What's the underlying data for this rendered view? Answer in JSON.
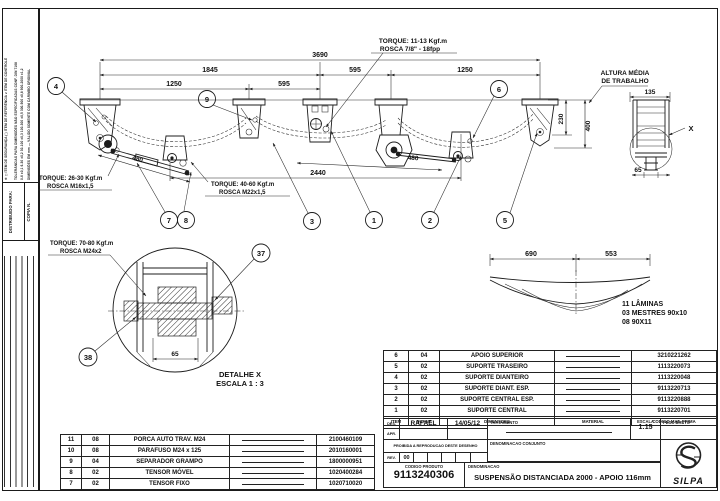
{
  "margin": {
    "note_symbols": "⊕   ◻ ITEM DE SEGURANÇA   ( ) ITEM DE REFERÊNCIA   ⌀ ITEM DE CONTROLE",
    "note_tol1": "TOLERÂNCIAS PARA DIMENSÕES NÃO ESPECIFICADAS CONF. DIN 7168",
    "note_tol2": "0-6 ±0,1   6-30 ±0,2   30-100 ±0,3   100-300 ±0,5   300-900 ±0,8   900-2000 ±1,2",
    "note_tol3": "DIMENSÕES EM mm — VÁLIDO SOMENTE COM CARIMBO ORIGINAL",
    "distribuido": "DISTRIBUIDO PARA:",
    "copia": "COPIA N."
  },
  "drawing": {
    "dims": {
      "total": "3690",
      "span_front": "1845",
      "span_mid": "595",
      "span_rear": "1250",
      "sub_front": "1250",
      "sub_mid": "595",
      "axles": "2440",
      "tensor_front": "480",
      "tensor_rear": "480",
      "h230": "230",
      "h400": "400",
      "w135": "135",
      "w65_side": "65"
    },
    "notes": {
      "torque_top1": "TORQUE: 11-13 Kgf.m",
      "torque_top2": "ROSCA 7/8\" - 18fpp",
      "torque_left1": "TORQUE: 26-30 Kgf.m",
      "torque_left2": "ROSCA M16x1,5",
      "torque_mid1": "TORQUE: 40-60 Kgf.m",
      "torque_mid2": "ROSCA M22x1,5",
      "altura1": "ALTURA MÉDIA",
      "altura2": "DE TRABALHO",
      "x_label": "X"
    },
    "balloons": {
      "b1": "1",
      "b2": "2",
      "b3": "3",
      "b4": "4",
      "b5": "5",
      "b6": "6",
      "b7": "7",
      "b8": "8",
      "b9": "9",
      "b37": "37",
      "b38": "38"
    },
    "spring": {
      "d_left": "690",
      "d_right": "553",
      "line1": "11 LÂMINAS",
      "line2": "03 MESTRES 90x10",
      "line3": "08 90X11"
    },
    "detail": {
      "torque1": "TORQUE: 70-80 Kgf.m",
      "torque2": "ROSCA M24x2",
      "dim": "65",
      "title": "DETALHE X",
      "scale": "ESCALA 1 : 3"
    }
  },
  "tables": {
    "left": {
      "rows": [
        {
          "item": "11",
          "qty": "08",
          "desc": "PORCA AUTO TRAV. M24",
          "code": "2100460109"
        },
        {
          "item": "10",
          "qty": "08",
          "desc": "PARAFUSO M24 x 125",
          "code": "2010160001"
        },
        {
          "item": "9",
          "qty": "04",
          "desc": "SEPARADOR GRAMPO",
          "code": "1800000951"
        },
        {
          "item": "8",
          "qty": "02",
          "desc": "TENSOR MÓVEL",
          "code": "1020400284"
        },
        {
          "item": "7",
          "qty": "02",
          "desc": "TENSOR FIXO",
          "code": "1020710020"
        }
      ]
    },
    "right": {
      "headers": {
        "item": "ITEM",
        "qty": "QUANT.",
        "desc": "DIMENSOES",
        "material": "MATERIAL",
        "code": "CODIGO MAT. PRIMA"
      },
      "rows": [
        {
          "item": "6",
          "qty": "04",
          "desc": "APOIO SUPERIOR",
          "code": "3210221262"
        },
        {
          "item": "5",
          "qty": "02",
          "desc": "SUPORTE TRASEIRO",
          "code": "1113220073"
        },
        {
          "item": "4",
          "qty": "02",
          "desc": "SUPORTE DIANTEIRO",
          "code": "1113220048"
        },
        {
          "item": "3",
          "qty": "02",
          "desc": "SUPORTE DIANT. ESP.",
          "code": "9113220713"
        },
        {
          "item": "2",
          "qty": "02",
          "desc": "SUPORTE CENTRAL ESP.",
          "code": "9113220888"
        },
        {
          "item": "1",
          "qty": "02",
          "desc": "SUPORTE CENTRAL",
          "code": "9113220701"
        }
      ]
    }
  },
  "titleblock": {
    "des_label": "DES.",
    "des_name": "RAFAEL",
    "des_date": "14/05/12",
    "apr_label": "APR.",
    "tratamento_label": "TRATAMENTO",
    "escala_label": "ESCALA",
    "escala_value": "1:15",
    "peso_label": "PESO BRUTO",
    "proibida": "PROIBIDA A REPRODUCAO DESTE DESENHO",
    "denom_conj_label": "DENOMINACAO CONJUNTO",
    "rev_label": "REV.",
    "rev_value": "00",
    "codigo_label": "CODIGO PRODUTO",
    "codigo_value": "9113240306",
    "denom_label": "DENOMINACAO",
    "denom_value": "SUSPENSÃO DISTANCIADA 2000 - APOIO 116mm",
    "logo_text": "SILPA"
  }
}
